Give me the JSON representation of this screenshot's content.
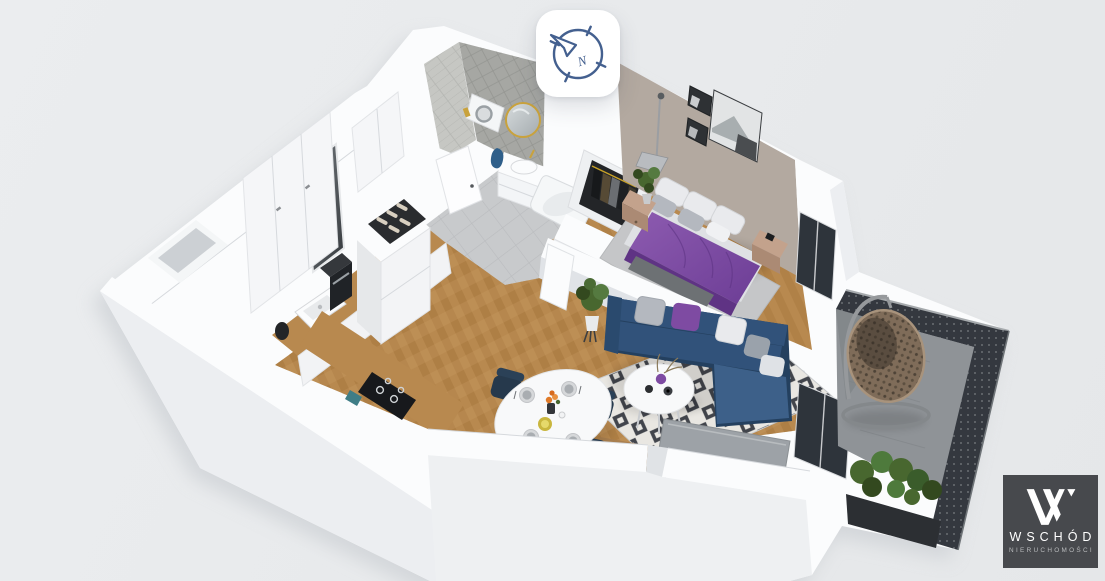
{
  "app": {
    "title": "3D apartment floor plan render"
  },
  "overlay": {
    "compass": {
      "icon": "compass-icon",
      "cardinal": "N",
      "label": "Orient view to north"
    },
    "watermark": {
      "mark": "W",
      "brand": "WSCHÓD",
      "tagline": "NIERUCHOMOŚCI"
    }
  },
  "scene": {
    "description": "Cutaway 3D bird's-eye render of a one-bedroom apartment with balcony",
    "rooms": [
      {
        "id": "kitchen",
        "name": "Kitchen",
        "features": [
          "white cabinet run",
          "wooden worktop",
          "sink",
          "coffee machine",
          "induction hob",
          "wine rack on fridge cabinet"
        ]
      },
      {
        "id": "hallway",
        "name": "Entry hall",
        "features": [
          "mirrored front door",
          "built-in wardrobe",
          "grey tile floor"
        ]
      },
      {
        "id": "bathroom",
        "name": "Bathroom",
        "features": [
          "grey herringbone tiled walls",
          "round gold-framed mirror",
          "washbasin cabinet",
          "bathtub",
          "washing machine",
          "blue towel"
        ]
      },
      {
        "id": "bedroom",
        "name": "Bedroom",
        "features": [
          "double bed with purple bedding",
          "white pillows",
          "two wooden nightstands",
          "floor lamp",
          "black and white wall art",
          "open wardrobe with clothes",
          "grey rug"
        ]
      },
      {
        "id": "living-room",
        "name": "Living room",
        "features": [
          "navy corner sofa",
          "purple and grey cushions",
          "round white coffee table",
          "black and white diamond rug",
          "TV panel",
          "potted plant",
          "herringbone oak floor"
        ]
      },
      {
        "id": "dining-area",
        "name": "Dining area",
        "features": [
          "oval white table",
          "four navy chairs",
          "set tableware",
          "orange flowers"
        ]
      },
      {
        "id": "balcony",
        "name": "Balcony",
        "features": [
          "hanging rattan egg chair",
          "planter with shrubs",
          "dark perforated metal railing",
          "concrete floor"
        ]
      }
    ]
  },
  "colors": {
    "bg": "#ebedef",
    "bg2": "#e5e7e9",
    "shell": "#fbfcfd",
    "face": "#eceef1",
    "shade": "#e0e3e7",
    "line": "#d6d9dd",
    "greige": "#b3a9a0",
    "tileA": "#c6c7c3",
    "tileB": "#a6a7a3",
    "floorGray": "#c8cacc",
    "wood": "#b8894f",
    "woodDark": "#a5763c",
    "woodLight": "#cb9d64",
    "woodFurn": "#a97f4f",
    "rugW": "#e9e7e2",
    "rugB": "#42454c",
    "bedRug": "#c5c6c8",
    "sofa": "#31527a",
    "sofaDeep": "#24405f",
    "sofaLite": "#3d6089",
    "purple": "#7e4ba2",
    "purpleDeep": "#5f3384",
    "pillowW": "#e9eaed",
    "pillowG": "#b4b8bf",
    "chair": "#2b4157",
    "tableW": "#f8f9fa",
    "tv": "#9da2a7",
    "glass": "#2e343b",
    "railing": "#34383f",
    "concrete": "#8f9397",
    "wicker": "#7f6c59",
    "wickerDark": "#4e4337",
    "leaf": "#48672f",
    "leafDark": "#33491f",
    "gold": "#c9a23c",
    "teal": "#3f7d86",
    "orange": "#e07a28",
    "yellow": "#c9b63e",
    "compass": "#44608f",
    "logoBg": "#47494d",
    "logoText": "#ffffff",
    "logoSub": "#b9bbbd"
  }
}
